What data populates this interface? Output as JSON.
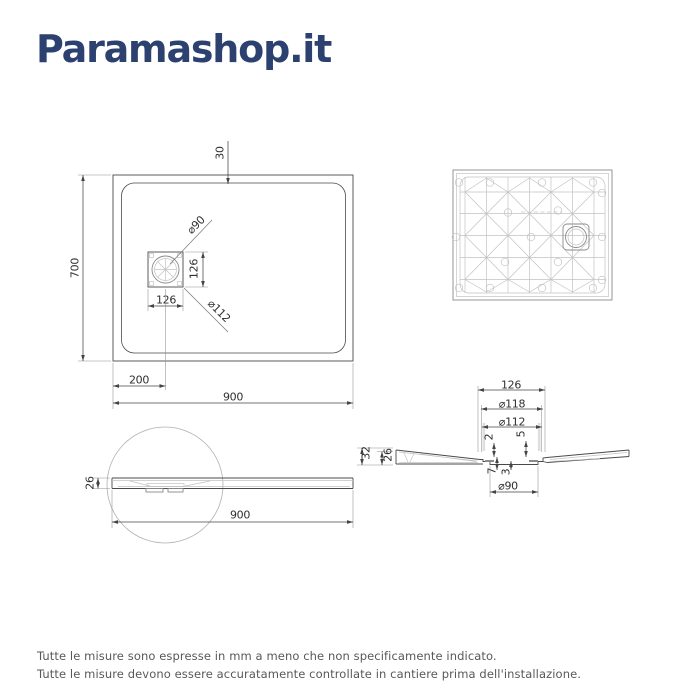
{
  "logo": {
    "text": "Paramashop.it",
    "color": "#2c4170"
  },
  "footer": {
    "line1": "Tutte le misure sono espresse in mm a meno che non specificamente indicato.",
    "line2": "Tutte le misure devono essere accuratamente controllate in cantiere prima dell'installazione."
  },
  "colors": {
    "logo_navy": "#2c4170",
    "line_dark": "#4a4a4a",
    "line_medium": "#8a8a8a",
    "line_light": "#c2c2c2",
    "dim_text": "#2f2f2f",
    "footer_text": "#585858"
  },
  "plan_view": {
    "dim_border_top": "30",
    "dim_height": "700",
    "dim_drain_diameter": "⌀90",
    "dim_drain_box_height": "126",
    "dim_drain_box_width": "126",
    "dim_flange_diameter": "⌀112",
    "dim_drain_offset": "200",
    "dim_width": "900"
  },
  "section_view": {
    "dim_recess_width": "126",
    "dim_flange_outer": "⌀118",
    "dim_flange_inner": "⌀112",
    "dim_lip": "2",
    "dim_seat": "5",
    "dim_total_height": "32",
    "dim_body_height": "26",
    "dim_step_left": "7",
    "dim_step_right": "3",
    "dim_drain_hole": "⌀90"
  },
  "side_view": {
    "dim_thickness": "26",
    "dim_length": "900"
  }
}
